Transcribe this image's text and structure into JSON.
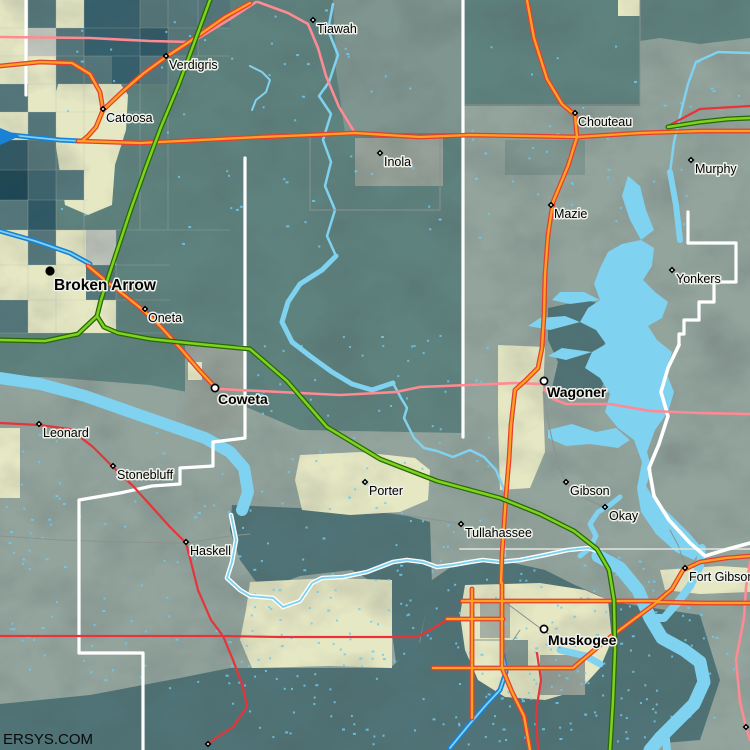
{
  "map": {
    "watermark": "ERSYS.COM",
    "description": "Terrain and census-shaded map of the Broken Arrow / Wagoner / Muskogee area of Oklahoma"
  },
  "palette": {
    "base_gray": "#93a49d",
    "teal": "#5e827e",
    "teal_light_wedge": "#7f958f",
    "teal_dark": "#4f7376",
    "teal_deep": "#35606d",
    "teal_deeper": "#2e5866",
    "teal_darkest": "#1d4654",
    "cell_mid": "#54777b",
    "cell_gray": "#c2c8be",
    "pale": "#e6e8c4",
    "gray_block": "#95a098",
    "gray_light": "#a8afa3",
    "water": "#7fd2f0",
    "water_dot": "#6fc9f2"
  },
  "road_styles": {
    "highway_orange": {
      "casing": "#e2402e",
      "line": "#ffa125"
    },
    "turnpike_green": {
      "casing": "#2b6604",
      "line": "#7cd421"
    },
    "secondary_pink": {
      "line": "#ff8a93"
    },
    "road_red": {
      "line": "#e63438"
    },
    "road_white": {
      "line": "#ffffff"
    },
    "river_channel": {
      "casing": "#1a82d4",
      "line": "#7fd2f0"
    },
    "boundary_gray": {
      "line": "#8a9290"
    },
    "county_light": {
      "line": "#dde2db"
    }
  },
  "marker_styles": {
    "diamond_fill": "#000000",
    "diamond_center": "#ffffff",
    "city_dot_fill": "#000000",
    "circle_fill": "#ffffff",
    "circle_stroke": "#000000"
  },
  "towns": [
    {
      "name": "Tiawah",
      "x": 313,
      "y": 20,
      "marker": "diamond",
      "size": "small",
      "dx": 4,
      "dy": 13
    },
    {
      "name": "Verdigris",
      "x": 166,
      "y": 56,
      "marker": "diamond",
      "size": "small",
      "dx": 3,
      "dy": 13
    },
    {
      "name": "Catoosa",
      "x": 103,
      "y": 109,
      "marker": "diamond",
      "size": "small",
      "dx": 3,
      "dy": 13
    },
    {
      "name": "Chouteau",
      "x": 575,
      "y": 113,
      "marker": "diamond",
      "size": "small",
      "dx": 3,
      "dy": 13
    },
    {
      "name": "Inola",
      "x": 380,
      "y": 153,
      "marker": "diamond",
      "size": "small",
      "dx": 4,
      "dy": 13
    },
    {
      "name": "Murphy",
      "x": 691,
      "y": 160,
      "marker": "diamond",
      "size": "small",
      "dx": 4,
      "dy": 13
    },
    {
      "name": "Mazie",
      "x": 551,
      "y": 205,
      "marker": "diamond",
      "size": "small",
      "dx": 3,
      "dy": 13
    },
    {
      "name": "Broken Arrow",
      "x": 50,
      "y": 271,
      "marker": "city-dot",
      "size": "large",
      "dx": 4,
      "dy": 19
    },
    {
      "name": "Yonkers",
      "x": 672,
      "y": 270,
      "marker": "diamond",
      "size": "small",
      "dx": 4,
      "dy": 13
    },
    {
      "name": "Oneta",
      "x": 145,
      "y": 309,
      "marker": "diamond",
      "size": "small",
      "dx": 3,
      "dy": 13
    },
    {
      "name": "Coweta",
      "x": 215,
      "y": 388,
      "marker": "circle",
      "size": "medium",
      "dx": 3,
      "dy": 16
    },
    {
      "name": "Wagoner",
      "x": 544,
      "y": 381,
      "marker": "circle",
      "size": "medium",
      "dx": 3,
      "dy": 16
    },
    {
      "name": "Leonard",
      "x": 39,
      "y": 424,
      "marker": "diamond",
      "size": "small",
      "dx": 4,
      "dy": 13
    },
    {
      "name": "Stonebluff",
      "x": 113,
      "y": 466,
      "marker": "diamond",
      "size": "small",
      "dx": 4,
      "dy": 13
    },
    {
      "name": "Porter",
      "x": 365,
      "y": 482,
      "marker": "diamond",
      "size": "small",
      "dx": 4,
      "dy": 13
    },
    {
      "name": "Gibson",
      "x": 566,
      "y": 482,
      "marker": "diamond",
      "size": "small",
      "dx": 4,
      "dy": 13
    },
    {
      "name": "Okay",
      "x": 605,
      "y": 507,
      "marker": "diamond",
      "size": "small",
      "dx": 4,
      "dy": 13
    },
    {
      "name": "Tullahassee",
      "x": 461,
      "y": 524,
      "marker": "diamond",
      "size": "small",
      "dx": 4,
      "dy": 13
    },
    {
      "name": "Haskell",
      "x": 186,
      "y": 542,
      "marker": "diamond",
      "size": "small",
      "dx": 4,
      "dy": 13
    },
    {
      "name": "Fort Gibson",
      "x": 685,
      "y": 568,
      "marker": "diamond",
      "size": "small",
      "dx": 4,
      "dy": 13
    },
    {
      "name": "Muskogee",
      "x": 544,
      "y": 629,
      "marker": "circle",
      "size": "medium",
      "dx": 4,
      "dy": 16
    },
    {
      "name": "",
      "x": 208,
      "y": 744,
      "marker": "diamond",
      "size": "small",
      "dx": 4,
      "dy": 13
    },
    {
      "name": "",
      "x": 746,
      "y": 727,
      "marker": "diamond",
      "size": "small",
      "dx": 4,
      "dy": 13
    }
  ]
}
